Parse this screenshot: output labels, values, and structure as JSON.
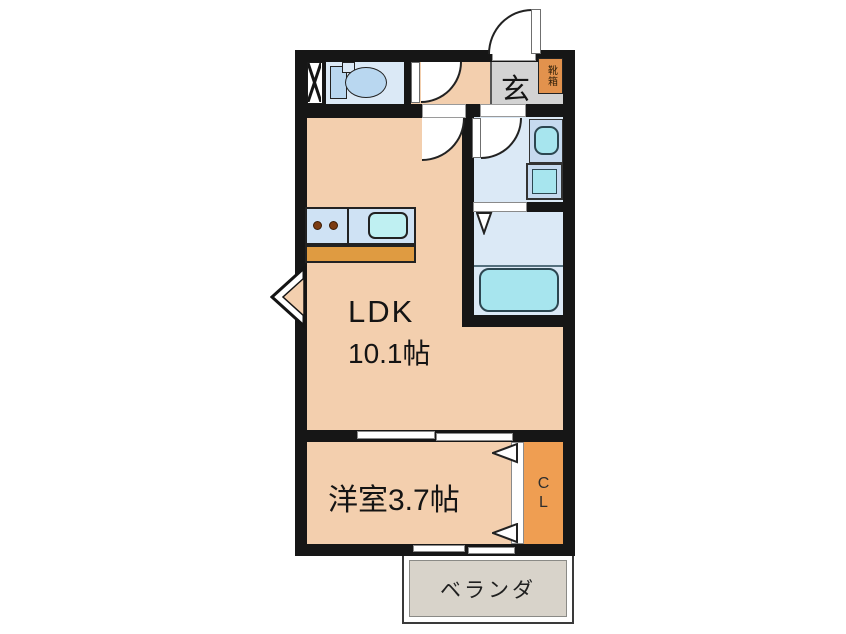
{
  "floor_plan": {
    "ldk": {
      "name": "LDK",
      "size": "10.1帖"
    },
    "western_room": {
      "label": "洋室3.7帖"
    },
    "entrance": {
      "label": "玄"
    },
    "shoe_cabinet": {
      "label": "靴箱"
    },
    "closet": {
      "line1": "C",
      "line2": "L"
    },
    "veranda": {
      "label": "ベランダ"
    },
    "colors": {
      "wall": "#161616",
      "floor_peach": "#f3cfae",
      "wet_area_blue": "#dbe9f6",
      "fixture_blue": "#b9d7f0",
      "water_cyan": "#a7e5ee",
      "counter_top_blue": "#cfe2f4",
      "counter_front_orange": "#df9b41",
      "entrance_gray": "#d3d3d3",
      "shoe_cabinet_orange": "#e2924d",
      "closet_orange": "#ef9e52",
      "veranda_gray": "#d8d3ca"
    }
  }
}
